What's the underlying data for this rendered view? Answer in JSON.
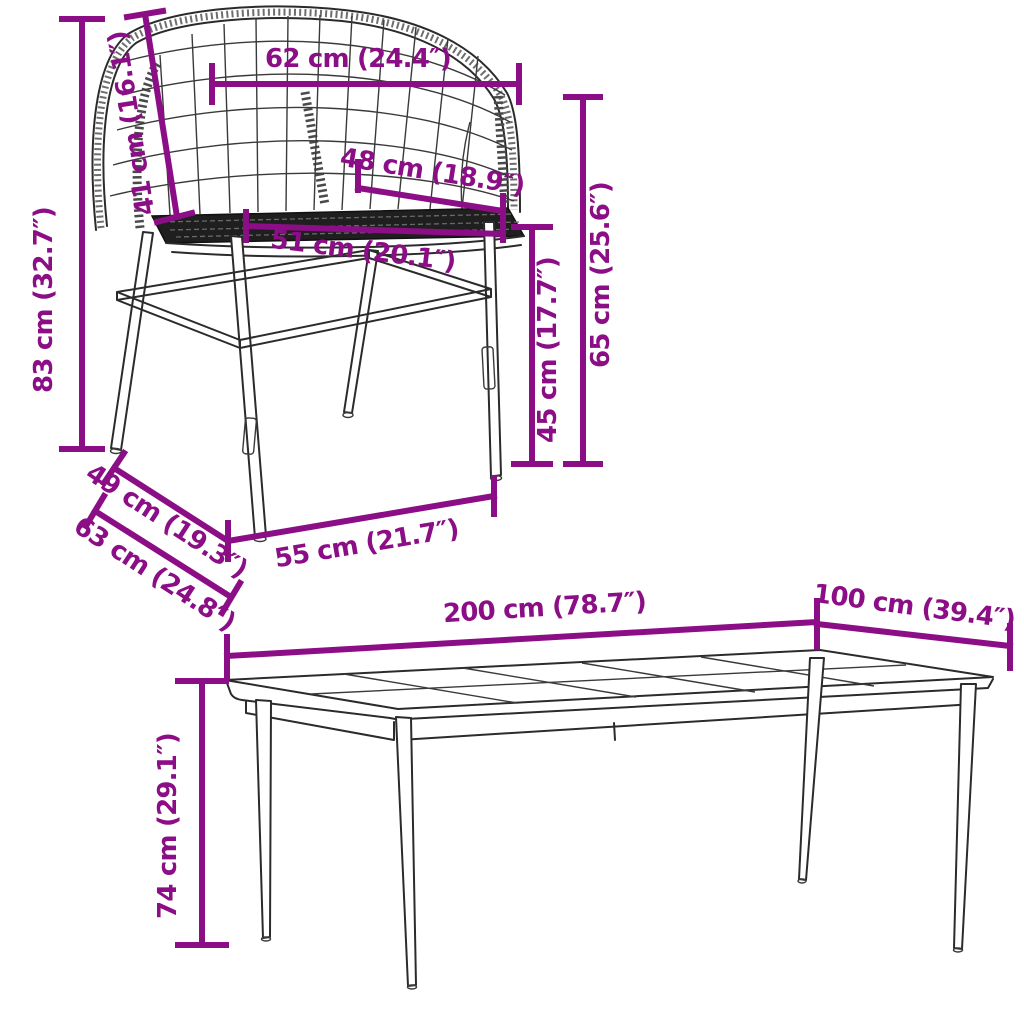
{
  "diagram": {
    "type": "furniture-dimension-diagram",
    "colors": {
      "dimension_accent": "#8B0E86",
      "line_art": "#2b2b2b",
      "background": "#ffffff"
    },
    "chair": {
      "name": "wicker-tub-chair",
      "dims": {
        "total_height": "83 cm (32.7″)",
        "backrest_height": "41 cm (16.1″)",
        "top_width": "62 cm (24.4″)",
        "seat_depth": "48 cm (18.9″)",
        "seat_width": "51 cm (20.1″)",
        "seat_height": "45 cm (17.7″)",
        "armrest_height": "65 cm (25.6″)",
        "depth_upper": "49 cm (19.3″)",
        "total_depth": "63 cm (24.8″)",
        "base_width": "55 cm (21.7″)"
      }
    },
    "table": {
      "name": "garden-dining-table",
      "dims": {
        "length": "200 cm (78.7″)",
        "width": "100 cm (39.4″)",
        "height": "74 cm (29.1″)"
      }
    }
  }
}
